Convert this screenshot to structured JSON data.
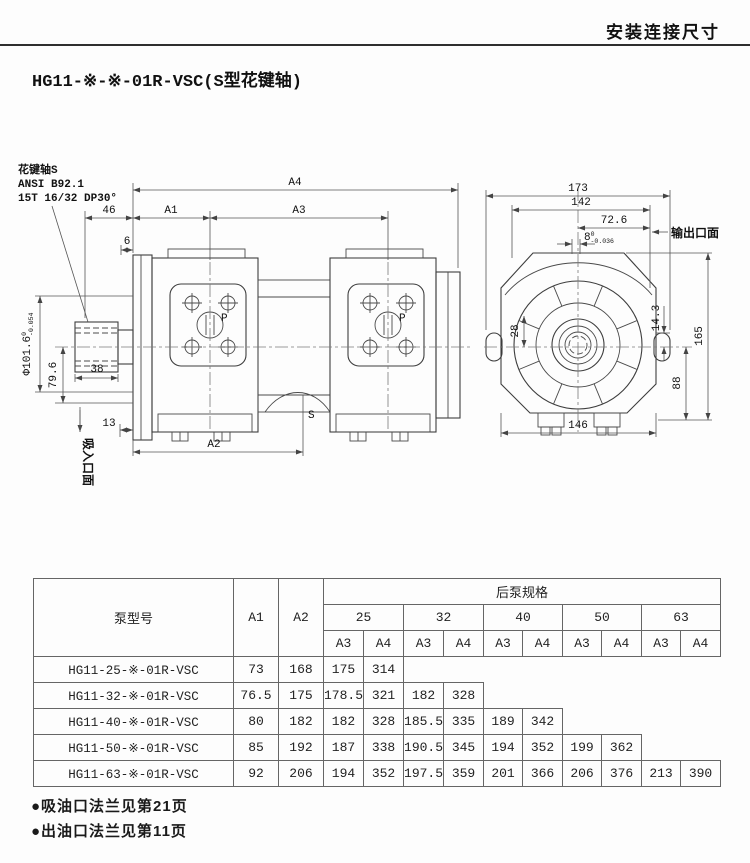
{
  "page": {
    "header": "安装连接尺寸",
    "title": "HG11-※-※-01R-VSC(S型花键轴)",
    "notes": [
      "●吸油口法兰见第21页",
      "●出油口法兰见第11页"
    ]
  },
  "drawing": {
    "spline_note": {
      "line1": "花键轴S",
      "line2": "ANSI B92.1",
      "line3": "15T 16/32 DP30°"
    },
    "labels": {
      "a4": "A4",
      "a1": "A1",
      "a3": "A3",
      "a2": "A2",
      "d46": "46",
      "d6": "6",
      "d38": "38",
      "d13": "13",
      "d79": "79.6",
      "dia": "Φ101.6",
      "dia_tol_hi": "0",
      "dia_tol_lo": "-0.054",
      "s": "S",
      "p": "P",
      "suction_face": "吸入口面",
      "d173": "173",
      "d142": "142",
      "d72": "72.6",
      "d8": "8",
      "d8_tol_hi": "0",
      "d8_tol_lo": "-0.036",
      "outlet_face": "输出口面",
      "d28": "28",
      "d14": "14.3",
      "d165": "165",
      "d88": "88",
      "d146": "146"
    }
  },
  "table": {
    "col_model": "泵型号",
    "col_a1": "A1",
    "col_a2": "A2",
    "group_header": "后泵规格",
    "sizes": [
      "25",
      "32",
      "40",
      "50",
      "63"
    ],
    "sub": [
      "A3",
      "A4"
    ],
    "rows": [
      {
        "model": "HG11-25-※-01R-VSC",
        "a1": "73",
        "a2": "168",
        "vals": [
          "175",
          "314"
        ]
      },
      {
        "model": "HG11-32-※-01R-VSC",
        "a1": "76.5",
        "a2": "175",
        "vals": [
          "178.5",
          "321",
          "182",
          "328"
        ]
      },
      {
        "model": "HG11-40-※-01R-VSC",
        "a1": "80",
        "a2": "182",
        "vals": [
          "182",
          "328",
          "185.5",
          "335",
          "189",
          "342"
        ]
      },
      {
        "model": "HG11-50-※-01R-VSC",
        "a1": "85",
        "a2": "192",
        "vals": [
          "187",
          "338",
          "190.5",
          "345",
          "194",
          "352",
          "199",
          "362"
        ]
      },
      {
        "model": "HG11-63-※-01R-VSC",
        "a1": "92",
        "a2": "206",
        "vals": [
          "194",
          "352",
          "197.5",
          "359",
          "201",
          "366",
          "206",
          "376",
          "213",
          "390"
        ]
      }
    ]
  }
}
